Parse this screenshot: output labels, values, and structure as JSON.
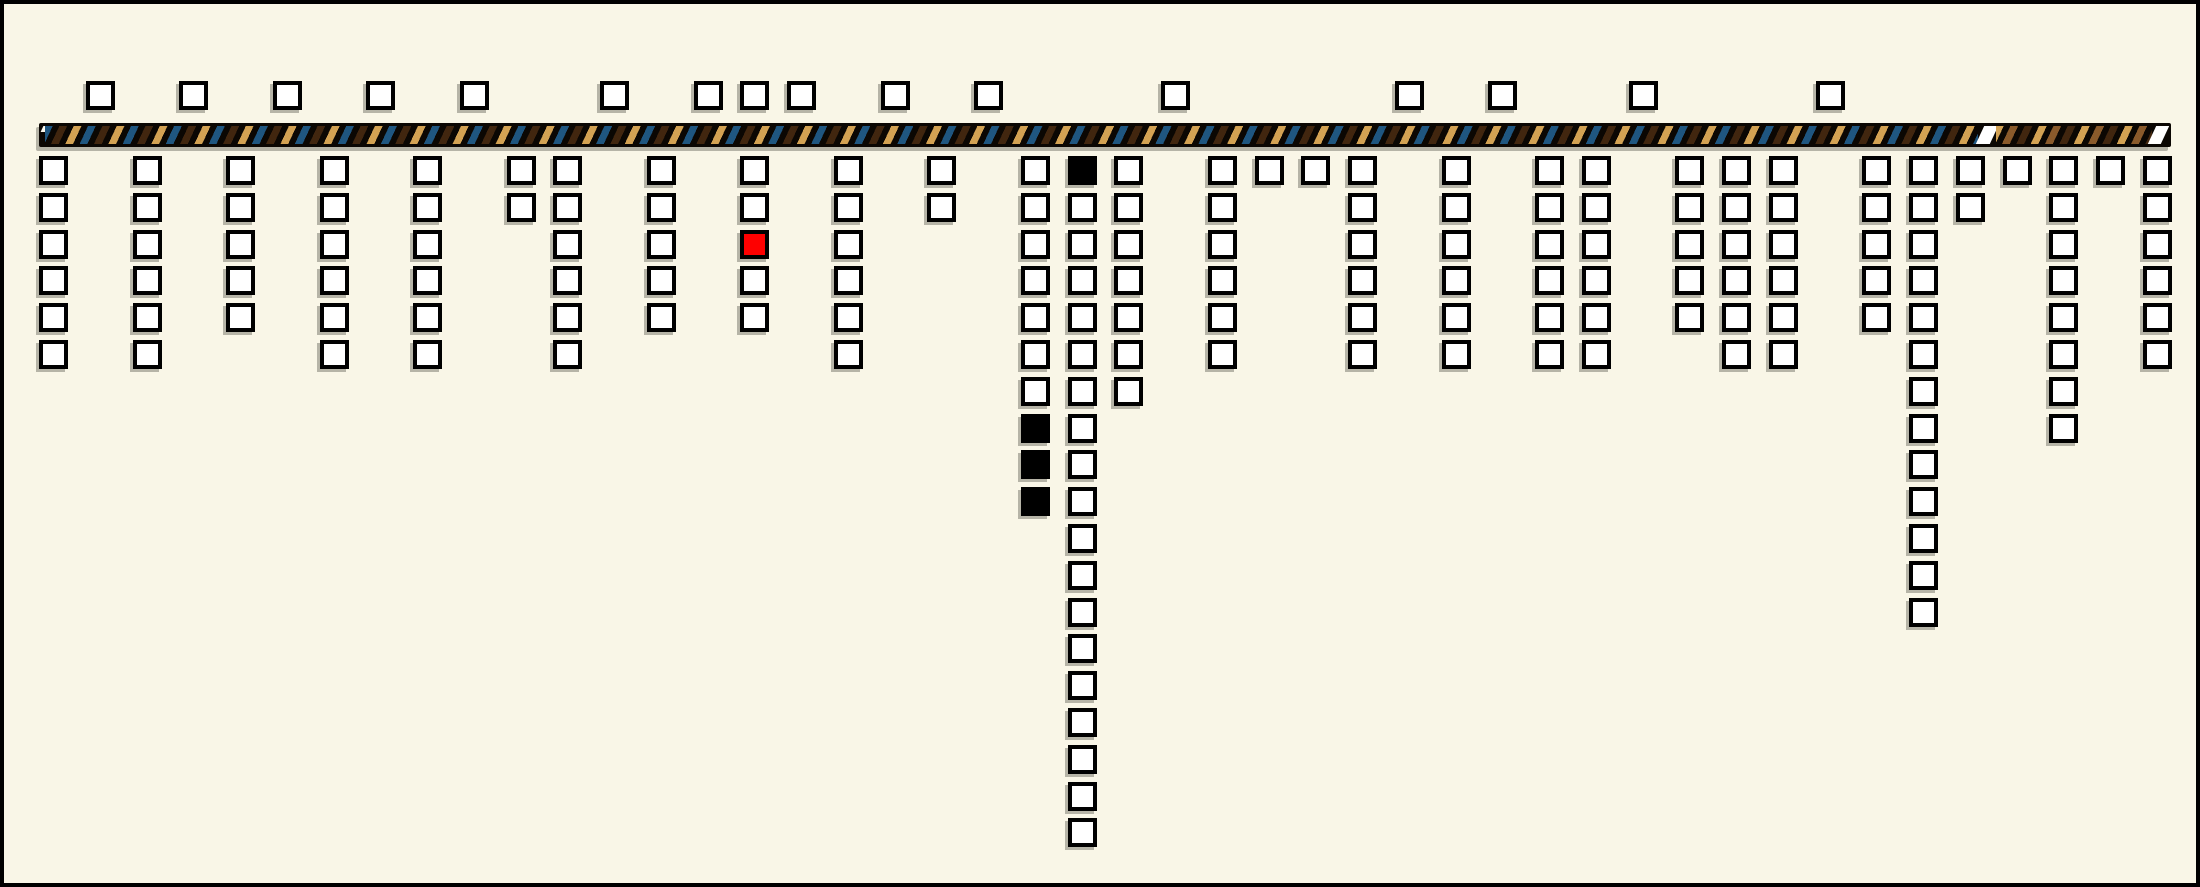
{
  "canvas": {
    "width": 2200,
    "height": 887,
    "background": "#f9f6e7",
    "border_color": "#000000"
  },
  "colors": {
    "background": "#f9f6e7",
    "square_border": "#000000",
    "square_fill": "#ffffff",
    "square_red": "#fe0000",
    "square_black": "#000000",
    "bar_black": "#0b0703",
    "stripe_blue": "#1f5680",
    "stripe_brown": "#41260f",
    "stripe_tan": "#d3a253",
    "stripe_sienna": "#8a5a2b",
    "stripe_white": "#ffffff"
  },
  "chart_data": {
    "type": "bar",
    "subtype": "unit-square pictograph along a striped timeline bar",
    "title": "",
    "xlabel": "",
    "ylabel": "",
    "legend": [],
    "slot_count": 46,
    "above_bar_slots": [
      1,
      3,
      5,
      7,
      9,
      12,
      14,
      15,
      16,
      18,
      20,
      24,
      29,
      31,
      34,
      38
    ],
    "above_bar_total_squares": 16,
    "below_columns": [
      {
        "slot": 0,
        "count": 6
      },
      {
        "slot": 2,
        "count": 6
      },
      {
        "slot": 4,
        "count": 5
      },
      {
        "slot": 6,
        "count": 6
      },
      {
        "slot": 8,
        "count": 6
      },
      {
        "slot": 10,
        "count": 2
      },
      {
        "slot": 11,
        "count": 6
      },
      {
        "slot": 13,
        "count": 5
      },
      {
        "slot": 15,
        "count": 5,
        "red_rows": [
          3
        ]
      },
      {
        "slot": 17,
        "count": 6
      },
      {
        "slot": 19,
        "count": 2
      },
      {
        "slot": 21,
        "count": 10,
        "black_rows": [
          8,
          9,
          10
        ]
      },
      {
        "slot": 22,
        "count": 19,
        "black_rows": [
          1
        ]
      },
      {
        "slot": 23,
        "count": 7
      },
      {
        "slot": 25,
        "count": 6
      },
      {
        "slot": 26,
        "count": 1
      },
      {
        "slot": 27,
        "count": 1
      },
      {
        "slot": 28,
        "count": 6
      },
      {
        "slot": 30,
        "count": 6
      },
      {
        "slot": 32,
        "count": 6
      },
      {
        "slot": 33,
        "count": 6
      },
      {
        "slot": 35,
        "count": 5
      },
      {
        "slot": 36,
        "count": 6
      },
      {
        "slot": 37,
        "count": 6
      },
      {
        "slot": 39,
        "count": 5
      },
      {
        "slot": 40,
        "count": 13
      },
      {
        "slot": 41,
        "count": 2
      },
      {
        "slot": 42,
        "count": 1
      },
      {
        "slot": 43,
        "count": 8
      },
      {
        "slot": 44,
        "count": 1
      },
      {
        "slot": 45,
        "count": 6
      }
    ],
    "bar": {
      "left_segment_stripe_sequence": [
        "blue",
        "dark-brown",
        "tan"
      ],
      "right_segment_stripe_sequence": [
        "tan",
        "sienna",
        "dark-brown"
      ],
      "has_white_break_before_right_segment": true,
      "has_white_end_tick": true,
      "has_small_white_start_tick": true
    },
    "grid": "off",
    "legend_position": "none"
  },
  "layout": {
    "slot_origin_x": 35,
    "slot_pitch": 46.75,
    "square_outer": 29,
    "above_row_y": 77,
    "row1_y": 152,
    "row_pitch": 36.8,
    "bar": {
      "x": 35,
      "y": 119,
      "width": 2132,
      "height": 24,
      "stripes_left_x": 6,
      "stripes_left_w": 1933,
      "break_x": 1941,
      "break_w": 14,
      "stripes_right_x": 1957,
      "stripes_right_w": 156,
      "end_tick_x": 2113,
      "end_tick_w": 13,
      "start_tick_x": 3,
      "start_tick_w": 5
    }
  }
}
